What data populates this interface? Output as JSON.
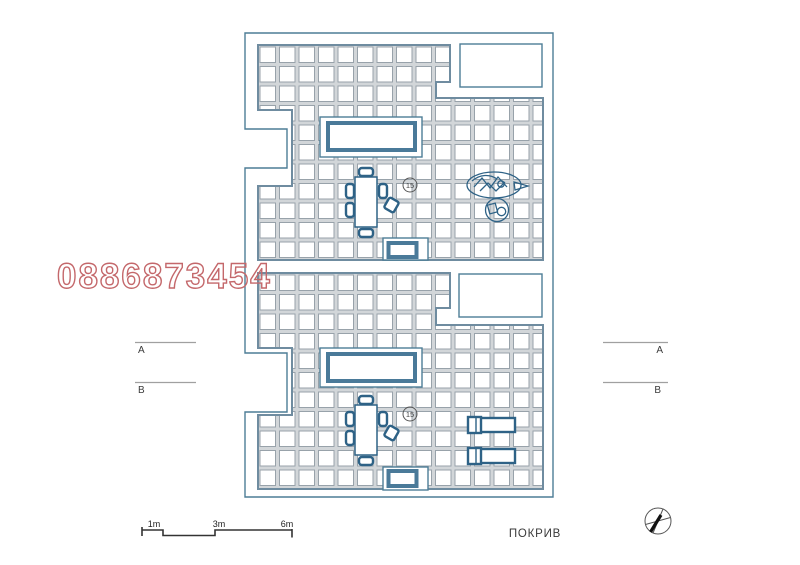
{
  "watermark": "0886873454",
  "drawing_title": "ПОКРИВ",
  "area_badges": {
    "upper": "15",
    "lower": "15"
  },
  "section_markers": {
    "left_top": "A",
    "left_bottom": "B",
    "right_top": "A",
    "right_bottom": "B"
  },
  "scale_bar": {
    "tick1": "1m",
    "tick2": "3m",
    "tick3": "6m"
  },
  "colors": {
    "outline": "#4d7d96",
    "tile_line": "#98a2aa",
    "grout": "#d2d6d9",
    "furniture": "#2e6286",
    "skylight_inner": "#4a7a99",
    "watermark": "#c4686b",
    "marker_line": "#a0a0a0",
    "text": "#3a3a3a"
  },
  "icons": {
    "north_arrow": "compass-circle-with-needle",
    "plant": "potted-plant-top-view",
    "grill": "round-table-with-vessels",
    "dining_table_upper": "table-with-six-chairs",
    "dining_table_lower": "table-with-six-chairs",
    "loungers": "two-sun-loungers",
    "skylights": "roof-skylight-rectangles"
  }
}
